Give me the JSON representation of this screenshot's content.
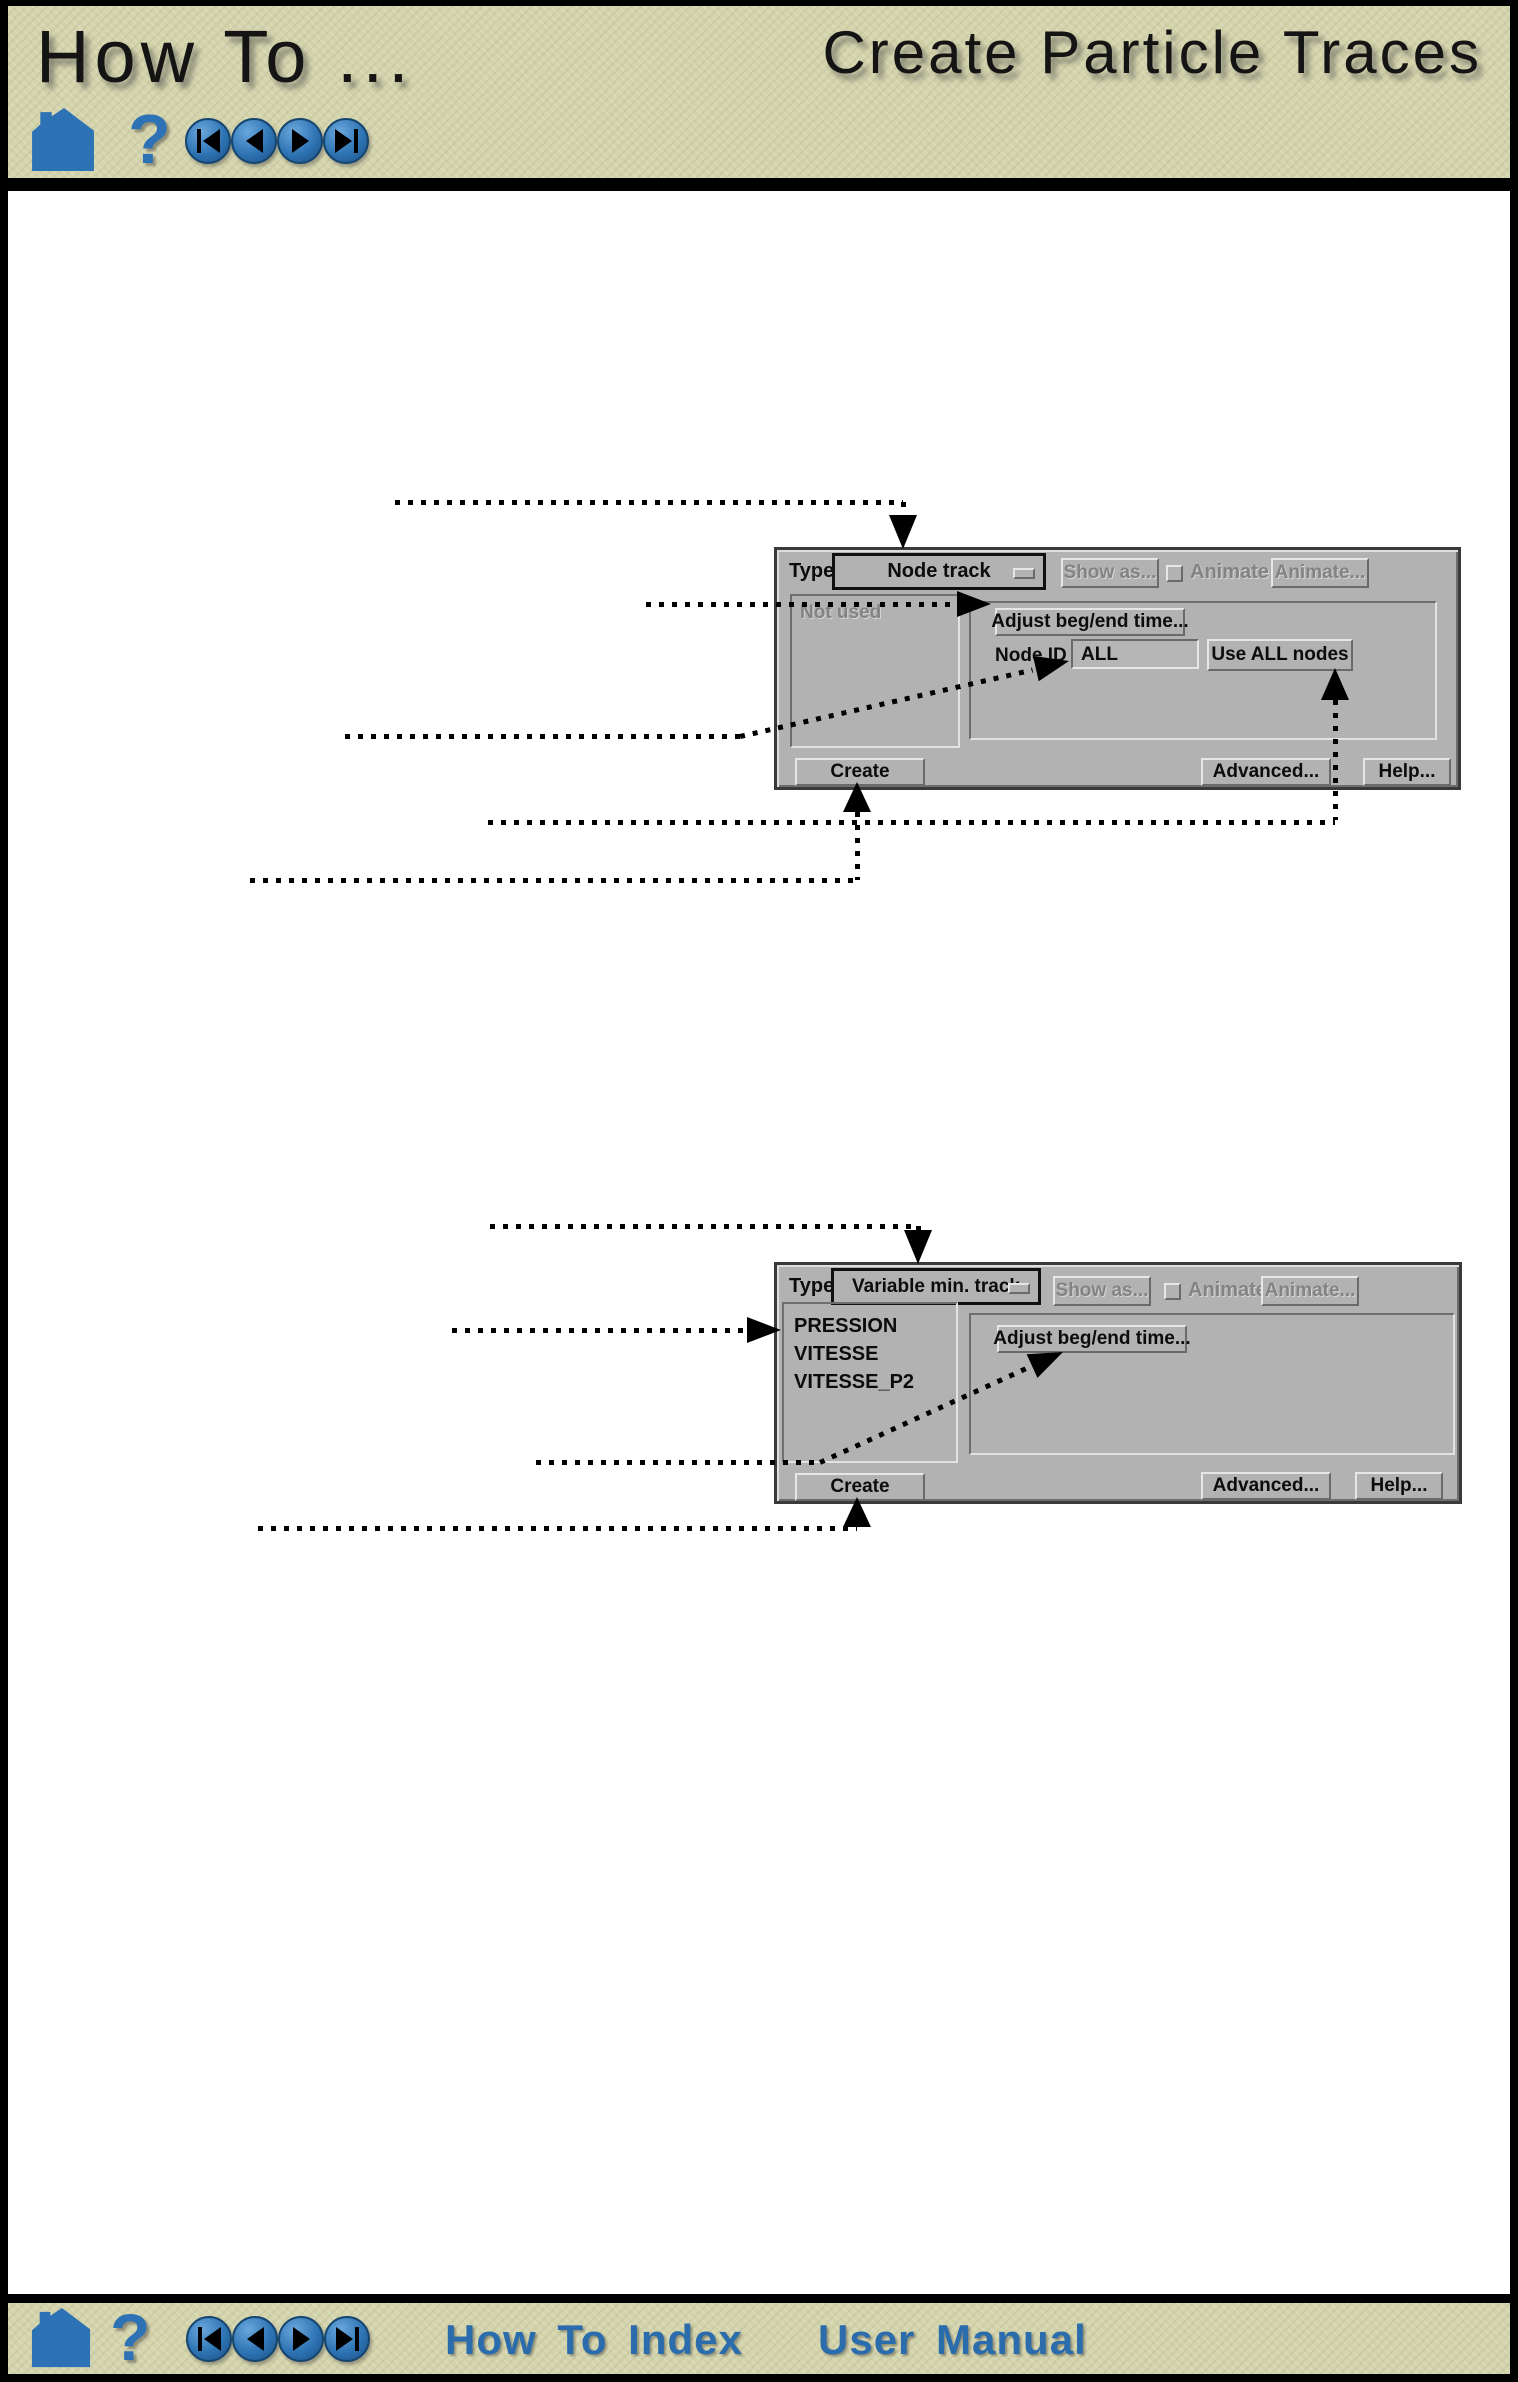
{
  "header": {
    "title_left": "How To ...",
    "title_right": "Create Particle Traces"
  },
  "nav": {
    "help_glyph": "?",
    "buttons": [
      "skip-to-first",
      "previous",
      "next",
      "skip-to-last"
    ]
  },
  "footer": {
    "index_link": "How To Index",
    "manual_link": "User Manual"
  },
  "colors": {
    "band_beige": "#d4d4ac",
    "icon_blue": "#2d72b4",
    "link_blue": "#2a6cac",
    "dialog_gray": "#b2b2b2",
    "bevel_light": "#e6e6e6",
    "bevel_dark": "#6a6a6a",
    "disabled_text": "#838383",
    "annotation": "#000000"
  },
  "dialog_node_track": {
    "type_label": "Type",
    "type_value": "Node track",
    "show_as_button": "Show as...",
    "animate_checkbox_label": "Animate",
    "animate_button": "Animate...",
    "list": [
      "Not used"
    ],
    "adjust_button": "Adjust beg/end time...",
    "node_id_label": "Node ID",
    "node_id_value": "ALL",
    "use_all_nodes_button": "Use ALL nodes",
    "create_button": "Create",
    "advanced_button": "Advanced...",
    "help_button": "Help..."
  },
  "dialog_variable_track": {
    "type_label": "Type",
    "type_value": "Variable min. track",
    "show_as_button": "Show as...",
    "animate_checkbox_label": "Animate",
    "animate_button": "Animate...",
    "list": [
      "PRESSION",
      "VITESSE",
      "VITESSE_P2"
    ],
    "adjust_button": "Adjust beg/end time...",
    "create_button": "Create",
    "advanced_button": "Advanced...",
    "help_button": "Help..."
  }
}
